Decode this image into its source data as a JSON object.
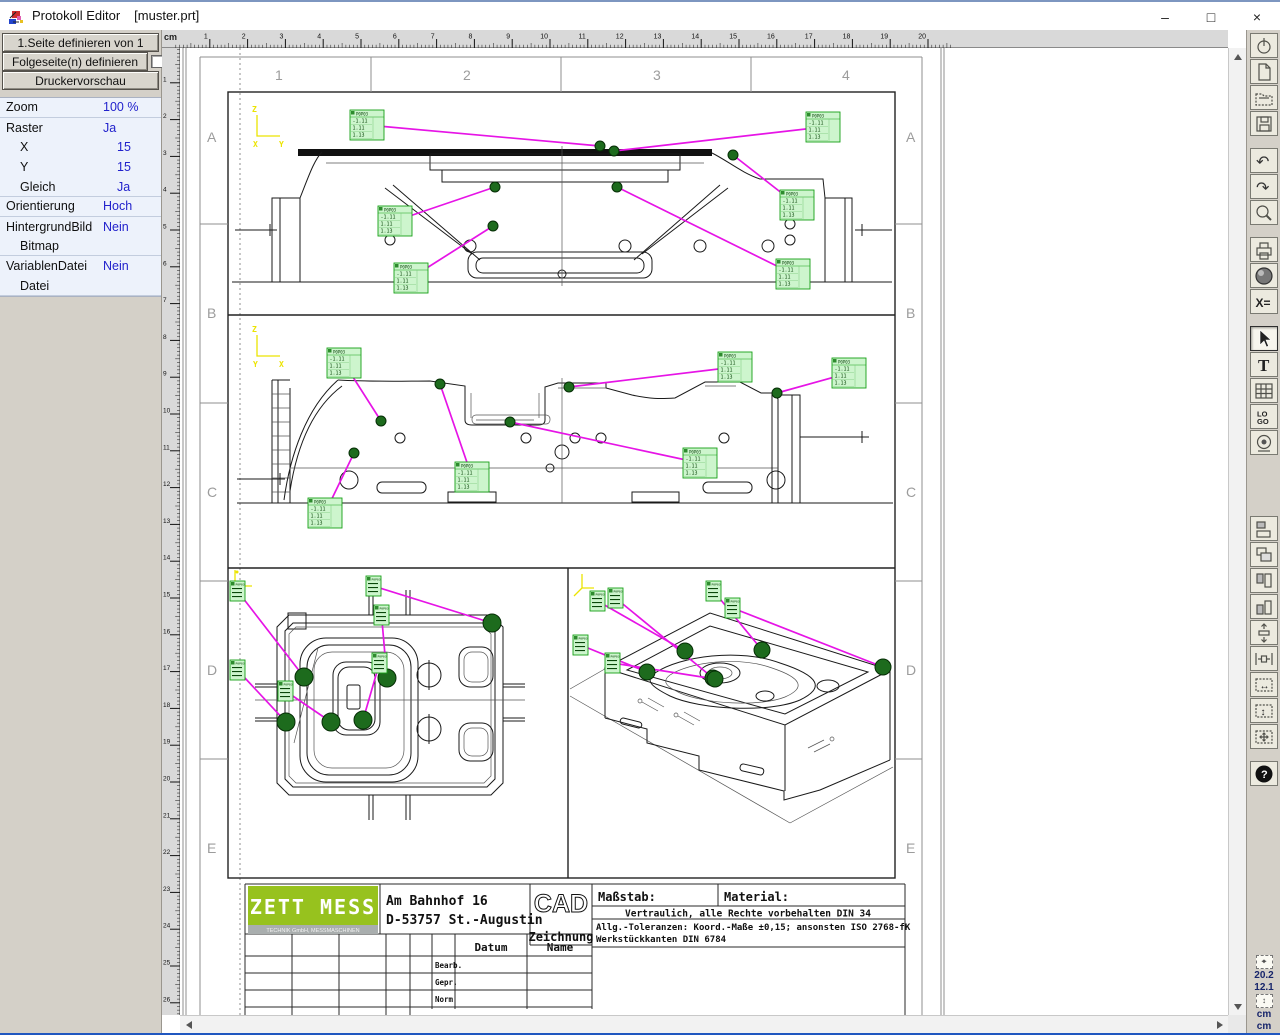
{
  "window": {
    "title": "Protokoll Editor",
    "document": "[muster.prt]",
    "controls": {
      "minimize": "–",
      "maximize": "□",
      "close": "×"
    }
  },
  "sidebar": {
    "buttons": [
      "1.Seite definieren von 1",
      "Folgeseite(n) definieren",
      "Druckervorschau"
    ],
    "properties": [
      {
        "label": "Zoom",
        "value": "100 %",
        "indent": 0,
        "sep": true
      },
      {
        "label": "Raster",
        "value": "Ja",
        "indent": 0,
        "sep": false
      },
      {
        "label": "X",
        "value": "15",
        "indent": 1,
        "sep": false
      },
      {
        "label": "Y",
        "value": "15",
        "indent": 1,
        "sep": false
      },
      {
        "label": "Gleich",
        "value": "Ja",
        "indent": 1,
        "sep": true
      },
      {
        "label": "Orientierung",
        "value": "Hoch",
        "indent": 0,
        "sep": true
      },
      {
        "label": "HintergrundBild",
        "value": "Nein",
        "indent": 0,
        "sep": false
      },
      {
        "label": "Bitmap",
        "value": "",
        "indent": 1,
        "sep": true
      },
      {
        "label": "VariablenDatei",
        "value": "Nein",
        "indent": 0,
        "sep": false
      },
      {
        "label": "Datei",
        "value": "",
        "indent": 1,
        "sep": true
      }
    ]
  },
  "rulers": {
    "unit": "cm",
    "h_max": 20,
    "v_max": 26
  },
  "page": {
    "columns": [
      "1",
      "2",
      "3",
      "4"
    ],
    "rows": [
      "A",
      "B",
      "C",
      "D",
      "E"
    ]
  },
  "axes": {
    "v1": {
      "up": "Z",
      "h1": "X",
      "h2": "Y"
    },
    "v2": {
      "up": "Z",
      "h1": "Y",
      "h2": "X"
    }
  },
  "measure_label": {
    "header": "P0P03",
    "rows": [
      "-1.11",
      "1.11",
      "1.13"
    ]
  },
  "annotations": {
    "view1": {
      "label_w": 34,
      "label_h": 30,
      "dot_r": 5,
      "items": [
        {
          "lx": 170,
          "ly": 62,
          "dx": 420,
          "dy": 98
        },
        {
          "lx": 626,
          "ly": 64,
          "dx": 434,
          "dy": 103
        },
        {
          "lx": 600,
          "ly": 142,
          "dx": 553,
          "dy": 107
        },
        {
          "lx": 596,
          "ly": 211,
          "dx": 437,
          "dy": 139
        },
        {
          "lx": 198,
          "ly": 158,
          "dx": 315,
          "dy": 139
        },
        {
          "lx": 214,
          "ly": 215,
          "dx": 313,
          "dy": 178
        }
      ]
    },
    "view2": {
      "label_w": 34,
      "label_h": 30,
      "dot_r": 5,
      "items": [
        {
          "lx": 147,
          "ly": 300,
          "dx": 201,
          "dy": 373
        },
        {
          "lx": 538,
          "ly": 304,
          "dx": 389,
          "dy": 339
        },
        {
          "lx": 652,
          "ly": 310,
          "dx": 597,
          "dy": 345
        },
        {
          "lx": 275,
          "ly": 414,
          "dx": 260,
          "dy": 336
        },
        {
          "lx": 503,
          "ly": 400,
          "dx": 330,
          "dy": 374
        },
        {
          "lx": 128,
          "ly": 450,
          "dx": 174,
          "dy": 405
        }
      ]
    },
    "view3": {
      "label_w": 15,
      "label_h": 20,
      "dot_r": 9,
      "items": [
        {
          "lx": 50,
          "ly": 533,
          "dx": 124,
          "dy": 629
        },
        {
          "lx": 186,
          "ly": 528,
          "dx": 312,
          "dy": 575
        },
        {
          "lx": 194,
          "ly": 557,
          "dx": 207,
          "dy": 630
        },
        {
          "lx": 50,
          "ly": 612,
          "dx": 106,
          "dy": 674
        },
        {
          "lx": 98,
          "ly": 633,
          "dx": 151,
          "dy": 674
        },
        {
          "lx": 192,
          "ly": 605,
          "dx": 183,
          "dy": 672
        }
      ]
    },
    "view4": {
      "label_w": 15,
      "label_h": 20,
      "dot_r": 8,
      "items": [
        {
          "lx": 410,
          "ly": 543,
          "dx": 505,
          "dy": 603
        },
        {
          "lx": 428,
          "ly": 540,
          "dx": 533,
          "dy": 630
        },
        {
          "lx": 526,
          "ly": 533,
          "dx": 582,
          "dy": 602
        },
        {
          "lx": 545,
          "ly": 550,
          "dx": 703,
          "dy": 619
        },
        {
          "lx": 393,
          "ly": 587,
          "dx": 467,
          "dy": 624
        },
        {
          "lx": 425,
          "ly": 605,
          "dx": 535,
          "dy": 631
        }
      ]
    }
  },
  "titleblock": {
    "company": "ZETT MESS",
    "company_sub": "TECHNIK GmbH, MESSMASCHINEN",
    "address1": "Am Bahnhof 16",
    "address2": "D-53757 St.-Augustin",
    "cad": "CAD",
    "cad_sub": "Zeichnung",
    "massstab": "Maßstab:",
    "material": "Material:",
    "note1": "Vertraulich, alle Rechte vorbehalten DIN 34",
    "note2": "Allg.-Toleranzen: Koord.-Maße ±0,15; ansonsten ISO 2768-fK",
    "note3": "Werkstückkanten DIN 6784",
    "datum": "Datum",
    "name": "Name",
    "rows": [
      "Bearb.",
      "Gepr.",
      "Norm"
    ]
  },
  "toolbar": {
    "active": "select-arrow",
    "items": [
      "power",
      "new-document",
      "open-folder",
      "save",
      "gap",
      "undo",
      "redo",
      "zoom",
      "gap",
      "print",
      "globe",
      "variables",
      "gap",
      "select-arrow",
      "text-tool",
      "table",
      "logo",
      "stamp",
      "biggap",
      "align-left",
      "align-overlap",
      "align-top",
      "align-bottom",
      "distribute-vertical",
      "distribute-horizontal",
      "size-horizontal",
      "size-vertical",
      "move",
      "gap",
      "help"
    ]
  },
  "status": {
    "x": "20.2",
    "y": "12.1",
    "unit_x": "cm",
    "unit_y": "cm"
  },
  "colors": {
    "magenta": "#e614e6",
    "label_bg": "#cdf5cd",
    "label_border": "#17a017",
    "dot_green": "#1d6b1d",
    "value_blue": "#2222cc",
    "axis_yellow": "#ece400",
    "logo_green": "#97c21e"
  }
}
